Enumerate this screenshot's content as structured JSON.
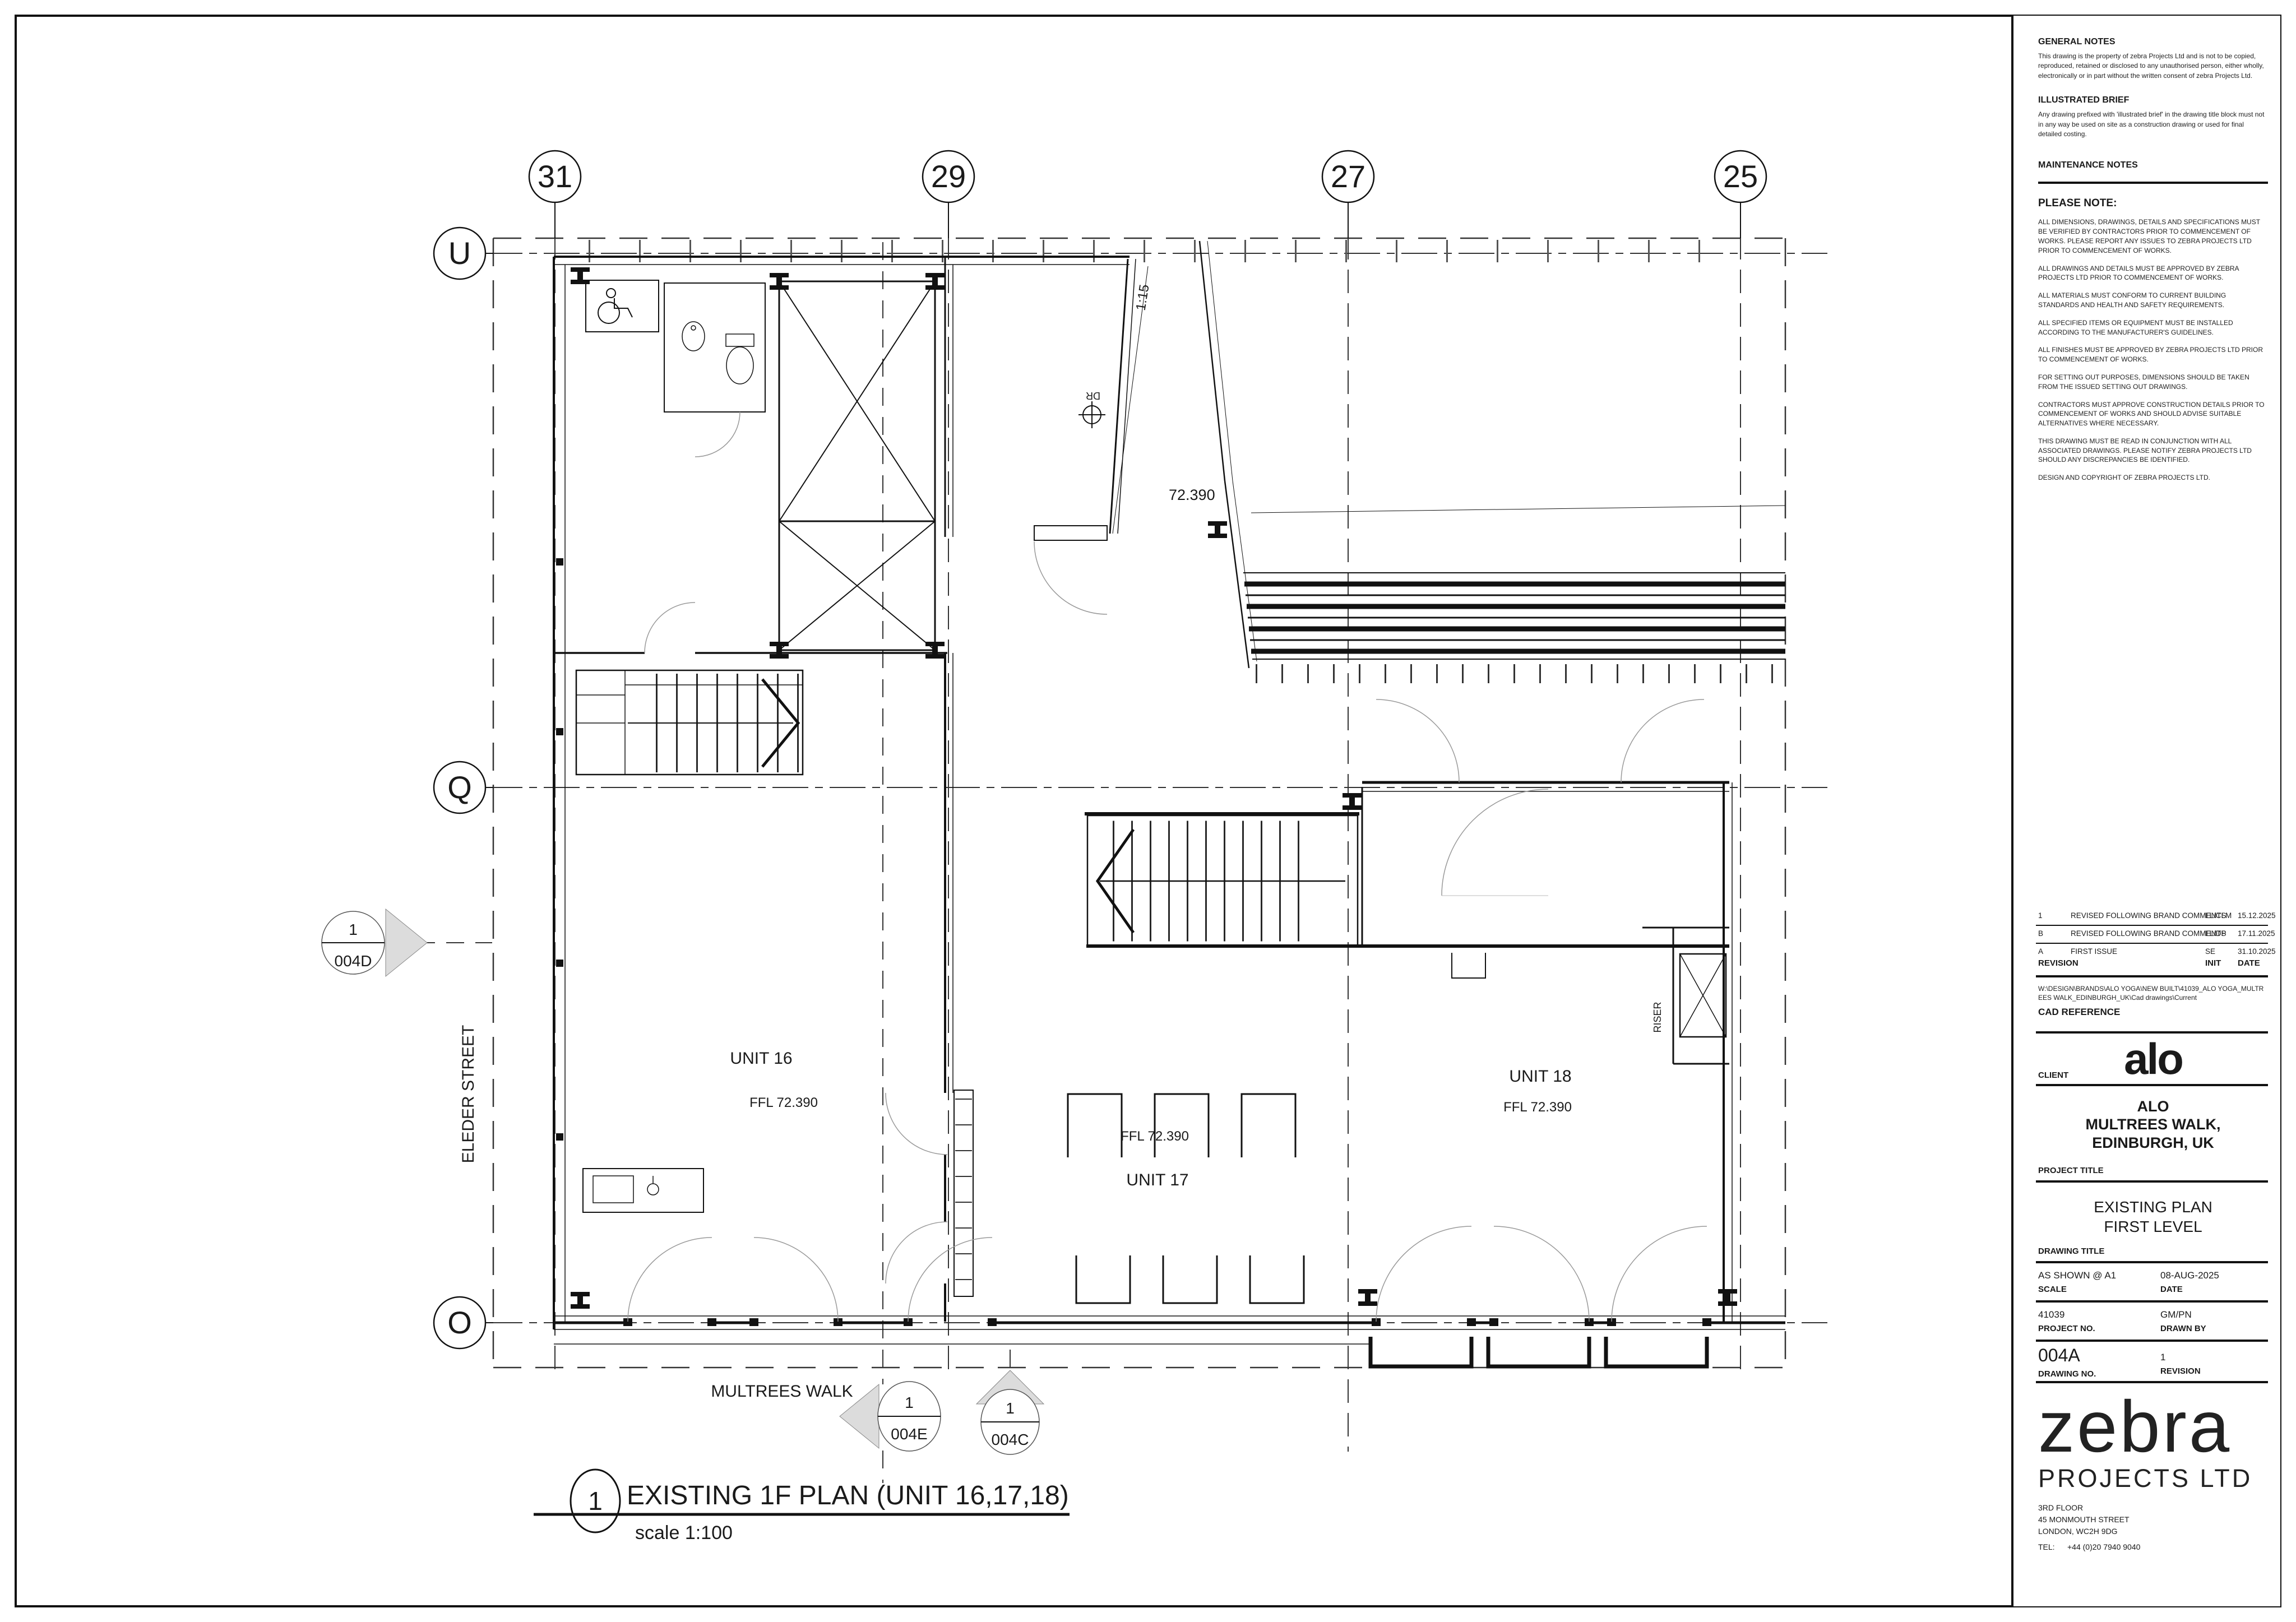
{
  "sheet": {
    "notes": {
      "general_title": "GENERAL NOTES",
      "general_body": "This drawing is the property of zebra Projects Ltd and is not to be copied, reproduced, retained or disclosed to any unauthorised person, either wholly, electronically or in part without the written consent of zebra Projects Ltd.",
      "illustrated_title": "ILLUSTRATED BRIEF",
      "illustrated_body": "Any drawing prefixed with 'illustrated brief' in the drawing title block must not in any way be used on site as a construction drawing or used for final detailed costing.",
      "maintenance_title": "MAINTENANCE NOTES",
      "please_note_title": "PLEASE NOTE:",
      "please_note_items": [
        "ALL DIMENSIONS, DRAWINGS, DETAILS AND SPECIFICATIONS MUST BE VERIFIED BY CONTRACTORS PRIOR TO COMMENCEMENT OF WORKS. PLEASE REPORT ANY ISSUES TO ZEBRA PROJECTS LTD PRIOR TO COMMENCEMENT OF WORKS.",
        "ALL DRAWINGS AND DETAILS MUST BE APPROVED BY ZEBRA PROJECTS LTD PRIOR TO COMMENCEMENT OF WORKS.",
        "ALL MATERIALS MUST CONFORM TO CURRENT BUILDING STANDARDS AND HEALTH AND SAFETY REQUIREMENTS.",
        "ALL SPECIFIED ITEMS OR EQUIPMENT MUST BE INSTALLED ACCORDING TO THE MANUFACTURER'S GUIDELINES.",
        "ALL FINISHES MUST BE APPROVED BY ZEBRA PROJECTS LTD PRIOR TO COMMENCEMENT OF WORKS.",
        "FOR SETTING OUT PURPOSES, DIMENSIONS SHOULD BE TAKEN FROM THE ISSUED SETTING OUT DRAWINGS.",
        "CONTRACTORS MUST APPROVE CONSTRUCTION DETAILS PRIOR TO COMMENCEMENT OF WORKS AND SHOULD ADVISE SUITABLE ALTERNATIVES WHERE NECESSARY.",
        "THIS DRAWING MUST BE READ IN CONJUNCTION WITH ALL ASSOCIATED DRAWINGS. PLEASE NOTIFY ZEBRA PROJECTS LTD SHOULD ANY DISCREPANCIES BE IDENTIFIED.",
        "DESIGN AND COPYRIGHT OF ZEBRA PROJECTS LTD."
      ]
    },
    "revision_table": {
      "rows": [
        {
          "rev": "1",
          "description": "REVISED FOLLOWING BRAND COMMENTS",
          "init": "LL/CLM",
          "date": "15.12.2025"
        },
        {
          "rev": "B",
          "description": "REVISED FOLLOWING BRAND COMMENTS",
          "init": "LL/DP",
          "date": "17.11.2025"
        },
        {
          "rev": "A",
          "description": "FIRST ISSUE",
          "init": "SE",
          "date": "31.10.2025"
        }
      ],
      "footer_rev": "REVISION",
      "footer_init": "INIT",
      "footer_date": "DATE"
    },
    "cad_reference": {
      "path": "W:\\DESIGN\\BRANDS\\ALO YOGA\\NEW BUILT\\41039_ALO YOGA_MULTREES WALK_EDINBURGH_UK\\Cad drawings\\Current",
      "label": "CAD REFERENCE"
    },
    "client": {
      "label": "CLIENT",
      "logo": "alo",
      "name_line1": "ALO",
      "name_line2": "MULTREES WALK,",
      "name_line3": "EDINBURGH, UK"
    },
    "project": {
      "label": "PROJECT TITLE",
      "title_line1": "EXISTING PLAN",
      "title_line2": "FIRST LEVEL"
    },
    "drawing_title_label": "DRAWING TITLE",
    "meta": {
      "scale_value": "AS SHOWN @ A1",
      "scale_label": "SCALE",
      "date_value": "08-AUG-2025",
      "date_label": "DATE",
      "project_no_value": "41039",
      "project_no_label": "PROJECT NO.",
      "drawn_by_value": "GM/PN",
      "drawn_by_label": "DRAWN BY",
      "drawing_no_value": "004A",
      "drawing_no_label": "DRAWING NO.",
      "revision_value": "1",
      "revision_label": "REVISION"
    },
    "firm": {
      "logo_main": "zebra",
      "logo_sub": "PROJECTS LTD",
      "address_line1": "3RD FLOOR",
      "address_line2": "45 MONMOUTH STREET",
      "address_line3": "LONDON, WC2H 9DG",
      "tel_label": "TEL:",
      "tel_value": "+44 (0)20 7940 9040"
    }
  },
  "plan": {
    "grid_columns": [
      {
        "label": "31"
      },
      {
        "label": "29"
      },
      {
        "label": "27"
      },
      {
        "label": "25"
      }
    ],
    "grid_rows": [
      {
        "label": "U"
      },
      {
        "label": "Q"
      },
      {
        "label": "O"
      }
    ],
    "units": [
      {
        "name": "UNIT 16",
        "ffl": "FFL 72.390"
      },
      {
        "name": "UNIT 17",
        "ffl": "FFL 72.390"
      },
      {
        "name": "UNIT 18",
        "ffl": "FFL 72.390"
      }
    ],
    "annotations": {
      "level": "72.390",
      "ramp": "1:15",
      "riser": "RISER",
      "drain": "DR"
    },
    "streets": {
      "left": "ELEDER STREET",
      "bottom": "MULTREES WALK"
    },
    "markers": {
      "left": {
        "num": "1",
        "ref": "004D"
      },
      "bottom_e": {
        "num": "1",
        "ref": "004E"
      },
      "bottom_c": {
        "num": "1",
        "ref": "004C"
      }
    },
    "view_title": {
      "num": "1",
      "text": "EXISTING 1F PLAN (UNIT 16,17,18)",
      "scale": "scale 1:100"
    }
  }
}
